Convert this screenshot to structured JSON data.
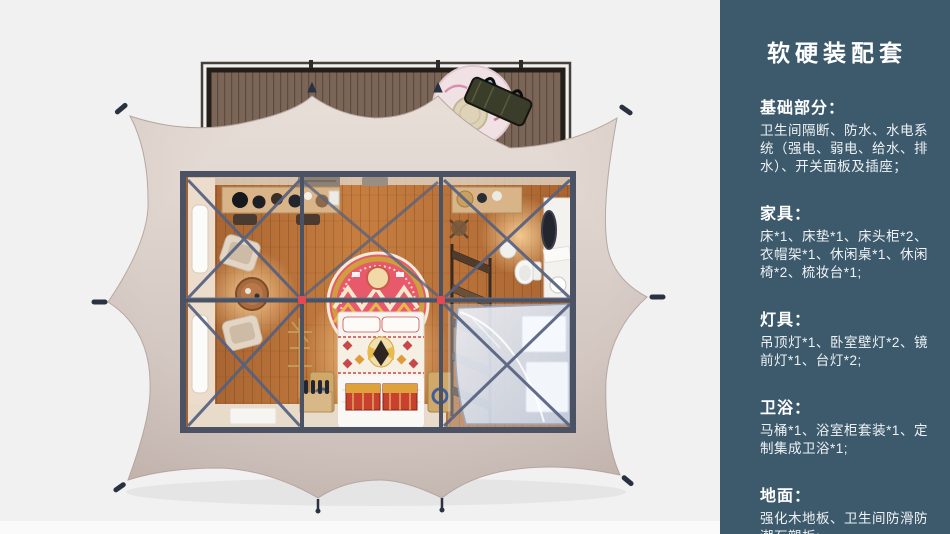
{
  "palette": {
    "page_bg": "#f1f1f2",
    "sidebar_bg": "#3d5a6c",
    "sidebar_text": "#ffffff",
    "tent_fabric": "#d6cac4",
    "deck_wood": "#7a6557",
    "room_floor": "#c67e40",
    "frame_steel": "#4a5264",
    "mandala_red": "#e8596b",
    "chest_red": "#c8402e",
    "glass_blue": "#ccd8ea",
    "connector_red": "#e04a50"
  },
  "sidebar": {
    "title": "软硬装配套",
    "sections": [
      {
        "heading": "基础部分：",
        "body": "卫生间隔断、防水、水电系统（强电、弱电、给水、排水）、开关面板及插座；"
      },
      {
        "heading": "家具：",
        "body": "床*1、床垫*1、床头柜*2、衣帽架*1、休闲桌*1、休闲椅*2、梳妆台*1;"
      },
      {
        "heading": "灯具：",
        "body": "吊顶灯*1、卧室壁灯*2、镜前灯*1、台灯*2;"
      },
      {
        "heading": "卫浴：",
        "body": "马桶*1、浴室柜套装*1、定制集成卫浴*1;"
      },
      {
        "heading": "地面：",
        "body": "强化木地板、卫生间防滑防潮石塑板;"
      }
    ]
  },
  "illustration": {
    "type": "3d-top-view-tent-floorplan",
    "elements": [
      "tent-canopy",
      "tent-pegs",
      "wood-deck",
      "deck-rug",
      "storage-bench",
      "steel-frame",
      "wood-floor",
      "side-windows",
      "console-desk",
      "lounge-chairs",
      "round-table",
      "mandala-rug",
      "bed",
      "red-chests",
      "clothes-rack",
      "dressing-mirror",
      "vanity",
      "toilet",
      "shower-glass",
      "floor-mats"
    ]
  }
}
